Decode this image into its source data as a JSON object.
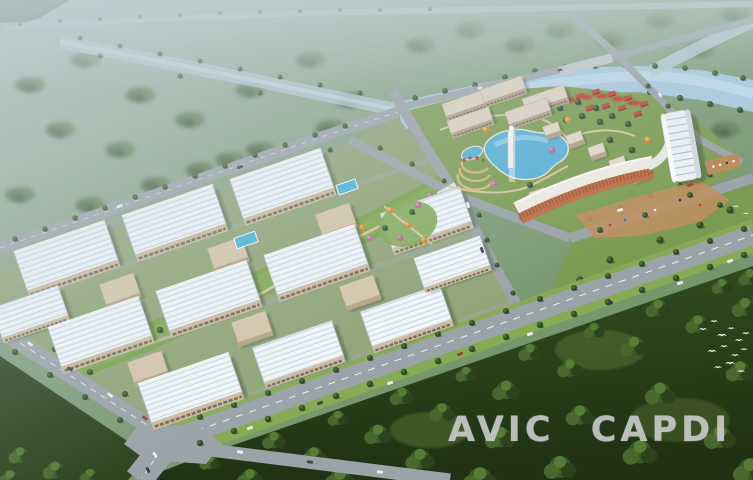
{
  "image": {
    "kind": "aerial-masterplan-architectural-rendering",
    "alt": "Bird's-eye rendering of an industrial office campus: rows of white factory buildings, a landscaped ribbon park, a lake district with fountain tower, crescent hotel and curved high-rise, canals with bridges, a tree-lined boulevard and a dense forest belt"
  },
  "watermark": {
    "text": "AVIC CAPDI"
  },
  "palette": {
    "haze": "#c3d2d6",
    "field": "#7f9a7c",
    "canal": "#a9cadf",
    "lake": "#57b1d9",
    "road": "#9aa3a8",
    "roadlight": "#b7bfc2",
    "roof": "#f3f7fa",
    "roofstripe": "#c9d7e1",
    "wall": "#cdbb9f",
    "wing": "#d6c6ac",
    "terracotta": "#bf6c44",
    "hotelroof": "#efece3",
    "towerfill": "#ecf1f5",
    "slab": "#ded4c2",
    "villa": "#b74a35",
    "flower": "#c23a2e",
    "lawn": "#79a24c",
    "ground": "#90a476",
    "district": "#7d9d54",
    "verge": "#86ab55",
    "forest": "#2f4720",
    "autumn": "#cf8a36",
    "pool": "#49b4da",
    "bird": "#fdfdfd",
    "shadow": "rgba(25,40,20,0.32)",
    "watermark": "#c9c9c9"
  },
  "scene": {
    "features": [
      "hazy-farmland",
      "tree-lined-canal",
      "canal-bridges",
      "industrial-campus-buildings",
      "landscaped-ribbon-park",
      "courtyard-pools",
      "lake-with-fountain-tower",
      "crescent-hotel-building",
      "curved-highrise-tower",
      "red-roof-villa-garden",
      "tree-lined-boulevard",
      "highway-intersection",
      "dense-forest-belt",
      "flying-birds"
    ],
    "birds_count": 15
  }
}
